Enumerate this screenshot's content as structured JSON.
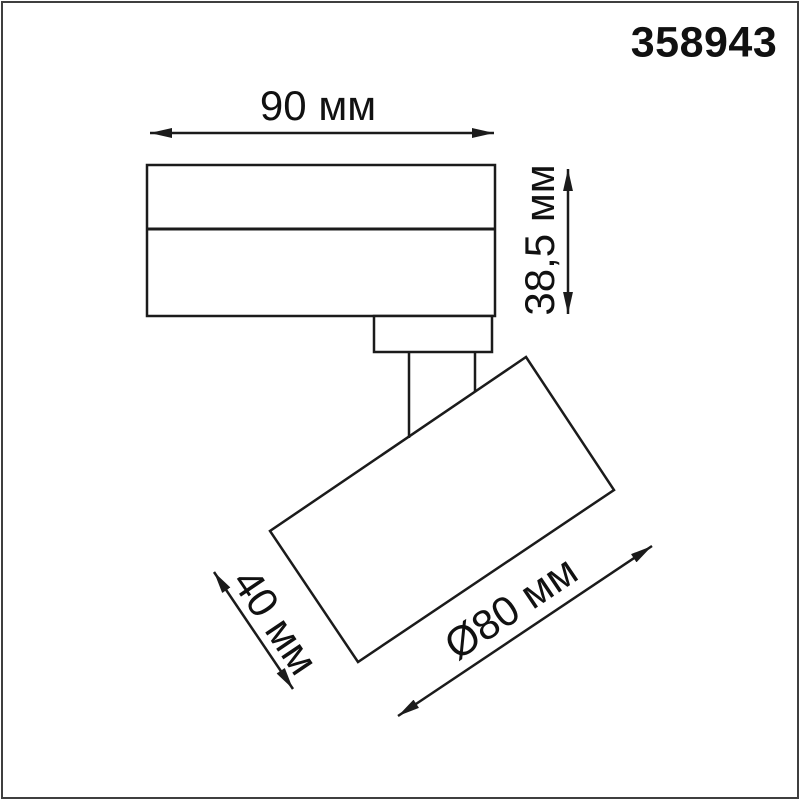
{
  "product_code": "358943",
  "dimensions": {
    "width": "90 мм",
    "height": "38,5 мм",
    "head_length": "40 мм",
    "head_diameter": "Ø80 мм"
  },
  "colors": {
    "line": "#1b1b1b",
    "text": "#111111",
    "frame": "#3f3f3f",
    "background": "#ffffff"
  }
}
